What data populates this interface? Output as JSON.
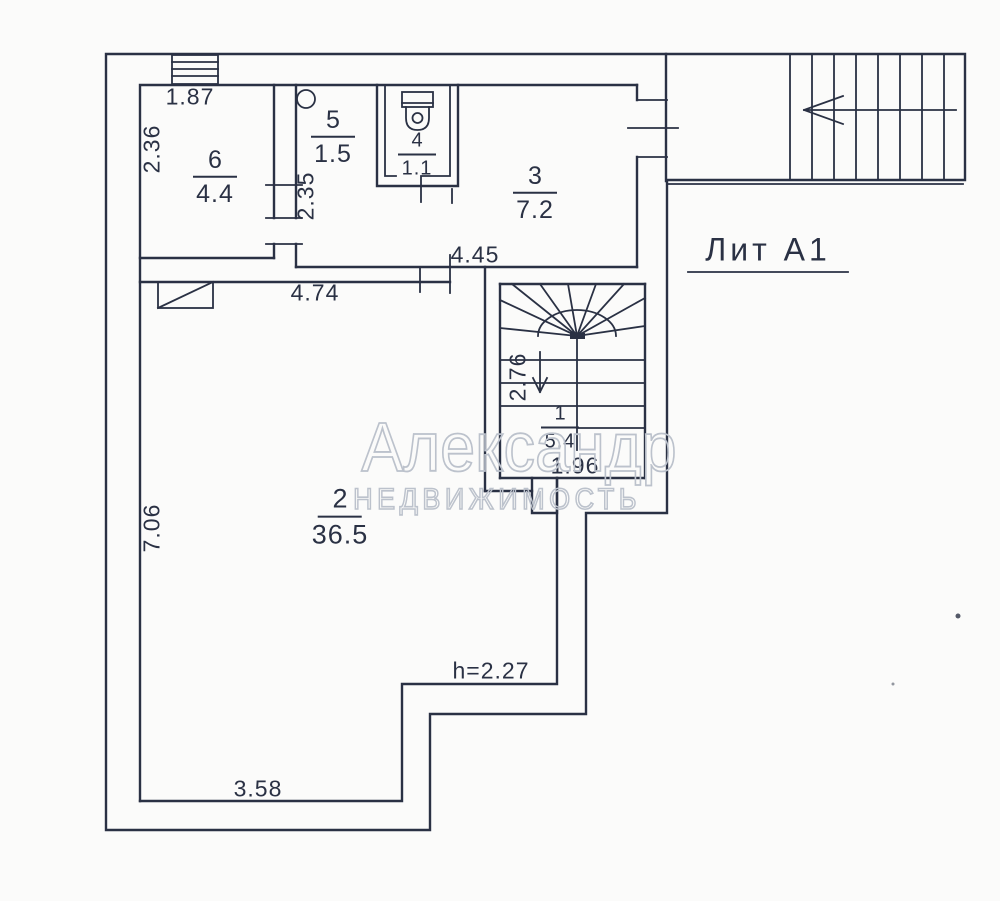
{
  "watermark": {
    "line1": "Александр",
    "line2": "НЕДВИЖИМОСТЬ"
  },
  "caption": {
    "liter": "Лит А1"
  },
  "rooms": {
    "r1": {
      "number": "1",
      "area": "5.4"
    },
    "r2": {
      "number": "2",
      "area": "36.5"
    },
    "r3": {
      "number": "3",
      "area": "7.2"
    },
    "r4": {
      "number": "4",
      "area": "1.1"
    },
    "r5": {
      "number": "5",
      "area": "1.5"
    },
    "r6": {
      "number": "6",
      "area": "4.4"
    }
  },
  "dimensions": {
    "room6_width": "1.87",
    "room6_depth": "2.36",
    "room5_depth": "2.35",
    "rooms_strip_width": "4.45",
    "room2_width": "4.74",
    "stair_depth": "2.76",
    "stair_width": "1.96",
    "room2_depth": "7.06",
    "room2_bottom_width": "3.58",
    "ceiling_height_note": "h=2.27"
  },
  "colors": {
    "ink": "#2a3144",
    "background": "#fbfbfa",
    "watermark_outline": "#bcc2cc"
  }
}
